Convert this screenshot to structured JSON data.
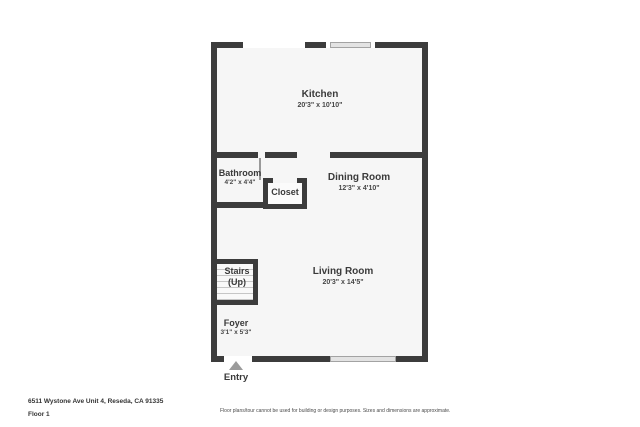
{
  "rooms": [
    {
      "name": "Kitchen",
      "dims": "20'3\" x 10'10\""
    },
    {
      "name": "Bathroom",
      "dims": "4'2\" x 4'4\""
    },
    {
      "name": "Closet"
    },
    {
      "name": "Dining Room",
      "dims": "12'3\" x 4'10\""
    },
    {
      "name": "Stairs",
      "sub": "(Up)"
    },
    {
      "name": "Living Room",
      "dims": "20'3\" x 14'5\""
    },
    {
      "name": "Foyer",
      "dims": "3'1\" x 5'3\""
    }
  ],
  "entry": {
    "label": "Entry"
  },
  "footer": {
    "address": "6511 Wystone Ave Unit 4, Reseda, CA 91335",
    "floor": "Floor 1",
    "disclaimer": "Floor plans/tour cannot be used for building or design purposes. Sizes and dimensions are approximate."
  },
  "colors": {
    "wall": "#3c3c3c",
    "floor_fill": "#f6f6f6",
    "window_fill": "#e3e3e3",
    "stair_tread": "#c6c6c6",
    "entry_arrow": "#9b9b9b",
    "text": "#3a3a3a"
  }
}
